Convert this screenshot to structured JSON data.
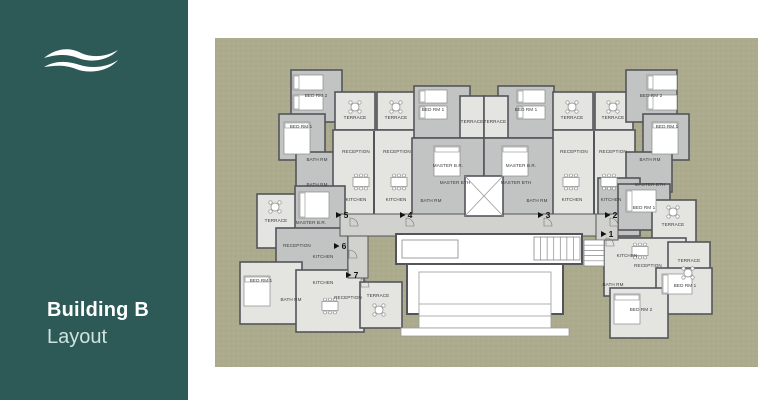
{
  "slide": {
    "bg": "#ffffff"
  },
  "sidebar": {
    "bg": "#2d5a56",
    "title": "Building B",
    "subtitle": "Layout",
    "title_color": "#ffffff",
    "subtitle_color": "#cfe3e0",
    "logo_icon": "wave-icon",
    "logo_color": "#ffffff"
  },
  "plan": {
    "bg": "#adab8d",
    "area": [
      215,
      38,
      543,
      329
    ],
    "colors": {
      "wall": "#54555b",
      "L": "#e4e4e1",
      "M": "#c2c4c4",
      "C": "#d1d1ce",
      "W": "#ffffff",
      "label": "#3a3a3a",
      "marker": "#111111",
      "furniture_stroke": "#8a8a8a"
    },
    "blocks": [
      [
        291,
        70,
        51,
        52,
        "M"
      ],
      [
        279,
        114,
        46,
        46,
        "M"
      ],
      [
        296,
        152,
        46,
        40,
        "M"
      ],
      [
        335,
        92,
        40,
        38,
        "L"
      ],
      [
        377,
        92,
        38,
        38,
        "L"
      ],
      [
        333,
        130,
        82,
        86,
        "L"
      ],
      [
        414,
        86,
        56,
        52,
        "M"
      ],
      [
        498,
        86,
        56,
        52,
        "M"
      ],
      [
        460,
        96,
        24,
        42,
        "L"
      ],
      [
        484,
        96,
        24,
        42,
        "L"
      ],
      [
        412,
        138,
        72,
        78,
        "M"
      ],
      [
        484,
        138,
        72,
        78,
        "M"
      ],
      [
        553,
        92,
        40,
        38,
        "L"
      ],
      [
        595,
        92,
        38,
        38,
        "L"
      ],
      [
        553,
        130,
        82,
        86,
        "L"
      ],
      [
        626,
        70,
        51,
        52,
        "M"
      ],
      [
        643,
        114,
        46,
        46,
        "M"
      ],
      [
        626,
        152,
        46,
        40,
        "M"
      ],
      [
        257,
        194,
        40,
        54,
        "L"
      ],
      [
        295,
        186,
        50,
        56,
        "M"
      ],
      [
        276,
        228,
        72,
        48,
        "M"
      ],
      [
        240,
        262,
        62,
        62,
        "L"
      ],
      [
        296,
        270,
        68,
        62,
        "L"
      ],
      [
        360,
        282,
        42,
        46,
        "L"
      ],
      [
        598,
        178,
        42,
        58,
        "M"
      ],
      [
        618,
        184,
        52,
        46,
        "M"
      ],
      [
        652,
        200,
        44,
        50,
        "L"
      ],
      [
        604,
        238,
        82,
        58,
        "L"
      ],
      [
        668,
        242,
        42,
        42,
        "L"
      ],
      [
        656,
        268,
        56,
        46,
        "L"
      ],
      [
        610,
        288,
        58,
        50,
        "L"
      ],
      [
        340,
        214,
        268,
        22,
        "C"
      ],
      [
        596,
        214,
        22,
        26,
        "C"
      ],
      [
        348,
        236,
        20,
        42,
        "C"
      ]
    ],
    "inner_walls": [
      [
        374,
        131,
        374,
        214
      ],
      [
        594,
        131,
        594,
        214
      ]
    ],
    "shaft": [
      465,
      176,
      38,
      40
    ],
    "lobby": {
      "outer": [
        396,
        234,
        186,
        30
      ],
      "left_room": [
        402,
        240,
        56,
        18
      ],
      "stairs_v": [
        534,
        237,
        46,
        23
      ],
      "stairs_h": [
        584,
        240,
        20,
        26
      ],
      "hall": [
        407,
        264,
        156,
        50
      ],
      "canopy": [
        419,
        272,
        132,
        56
      ],
      "canopy_lines_y": [
        304,
        316
      ],
      "apron": [
        401,
        328,
        168,
        8
      ]
    },
    "labels": [
      [
        "BED RM 2",
        316,
        97
      ],
      [
        "BED RM 1",
        301,
        128
      ],
      [
        "BATH RM",
        317,
        161
      ],
      [
        "BATH RM",
        317,
        186
      ],
      [
        "TERRACE",
        355,
        119
      ],
      [
        "TERRACE",
        396,
        119
      ],
      [
        "RECEPTION",
        356,
        153
      ],
      [
        "RECEPTION",
        397,
        153
      ],
      [
        "KITCHEN",
        356,
        201
      ],
      [
        "KITCHEN",
        396,
        201
      ],
      [
        "BED RM 1",
        433,
        111
      ],
      [
        "BED RM 1",
        526,
        111
      ],
      [
        "TERRACE",
        472,
        123
      ],
      [
        "TERRACE",
        495,
        123
      ],
      [
        "MASTER B.R.",
        448,
        167
      ],
      [
        "MASTER B.R.",
        521,
        167
      ],
      [
        "MASTER BTH",
        455,
        184
      ],
      [
        "MASTER BTH",
        516,
        184
      ],
      [
        "BATH RM",
        431,
        202
      ],
      [
        "BATH RM",
        537,
        202
      ],
      [
        "TERRACE",
        572,
        119
      ],
      [
        "TERRACE",
        613,
        119
      ],
      [
        "RECEPTION",
        574,
        153
      ],
      [
        "RECEPTION",
        613,
        153
      ],
      [
        "KITCHEN",
        572,
        201
      ],
      [
        "KITCHEN",
        611,
        201
      ],
      [
        "BED RM 2",
        651,
        97
      ],
      [
        "BED RM 1",
        667,
        128
      ],
      [
        "BATH RM",
        650,
        161
      ],
      [
        "MASTER BTH",
        650,
        186
      ],
      [
        "TERRACE",
        276,
        222
      ],
      [
        "MASTER B.R.",
        311,
        224
      ],
      [
        "RECEPTION",
        297,
        247
      ],
      [
        "KITCHEN",
        323,
        258
      ],
      [
        "BED RM 1",
        261,
        282
      ],
      [
        "BATH RM",
        291,
        301
      ],
      [
        "KITCHEN",
        323,
        284
      ],
      [
        "RECEPTION",
        348,
        299
      ],
      [
        "TERRACE",
        378,
        297
      ],
      [
        "BED RM 1",
        644,
        209
      ],
      [
        "TERRACE",
        673,
        226
      ],
      [
        "KITCHEN",
        627,
        257
      ],
      [
        "RECEPTION",
        648,
        267
      ],
      [
        "TERRACE",
        689,
        262
      ],
      [
        "BED RM 1",
        685,
        287
      ],
      [
        "BED RM 2",
        641,
        311
      ],
      [
        "BATH RM",
        613,
        286
      ]
    ],
    "unit_markers": [
      [
        "5",
        346,
        215
      ],
      [
        "4",
        410,
        215
      ],
      [
        "3",
        548,
        215
      ],
      [
        "2",
        615,
        215
      ],
      [
        "1",
        611,
        234
      ],
      [
        "6",
        344,
        246
      ],
      [
        "7",
        356,
        275
      ]
    ],
    "furniture": {
      "round_tables": [
        [
          355,
          107
        ],
        [
          396,
          107
        ],
        [
          572,
          107
        ],
        [
          613,
          107
        ],
        [
          275,
          207
        ],
        [
          379,
          310
        ],
        [
          673,
          212
        ],
        [
          688,
          273
        ]
      ],
      "dining_tables": [
        [
          361,
          182
        ],
        [
          399,
          182
        ],
        [
          571,
          182
        ],
        [
          609,
          182
        ],
        [
          330,
          306
        ],
        [
          640,
          251
        ]
      ],
      "beds": [
        [
          293,
          75,
          30,
          15
        ],
        [
          293,
          95,
          30,
          15
        ],
        [
          284,
          122,
          26,
          32
        ],
        [
          419,
          90,
          28,
          13
        ],
        [
          419,
          106,
          28,
          13
        ],
        [
          517,
          90,
          28,
          13
        ],
        [
          517,
          106,
          28,
          13
        ],
        [
          434,
          146,
          26,
          30
        ],
        [
          502,
          146,
          26,
          30
        ],
        [
          647,
          75,
          30,
          15
        ],
        [
          647,
          95,
          30,
          15
        ],
        [
          652,
          122,
          26,
          32
        ],
        [
          299,
          192,
          30,
          26
        ],
        [
          244,
          276,
          26,
          30
        ],
        [
          626,
          190,
          30,
          22
        ],
        [
          662,
          274,
          30,
          20
        ],
        [
          614,
          294,
          26,
          30
        ]
      ],
      "doors": [
        [
          350,
          218
        ],
        [
          406,
          218
        ],
        [
          544,
          218
        ],
        [
          610,
          218
        ],
        [
          349,
          250
        ],
        [
          361,
          279
        ],
        [
          606,
          238
        ]
      ]
    }
  }
}
